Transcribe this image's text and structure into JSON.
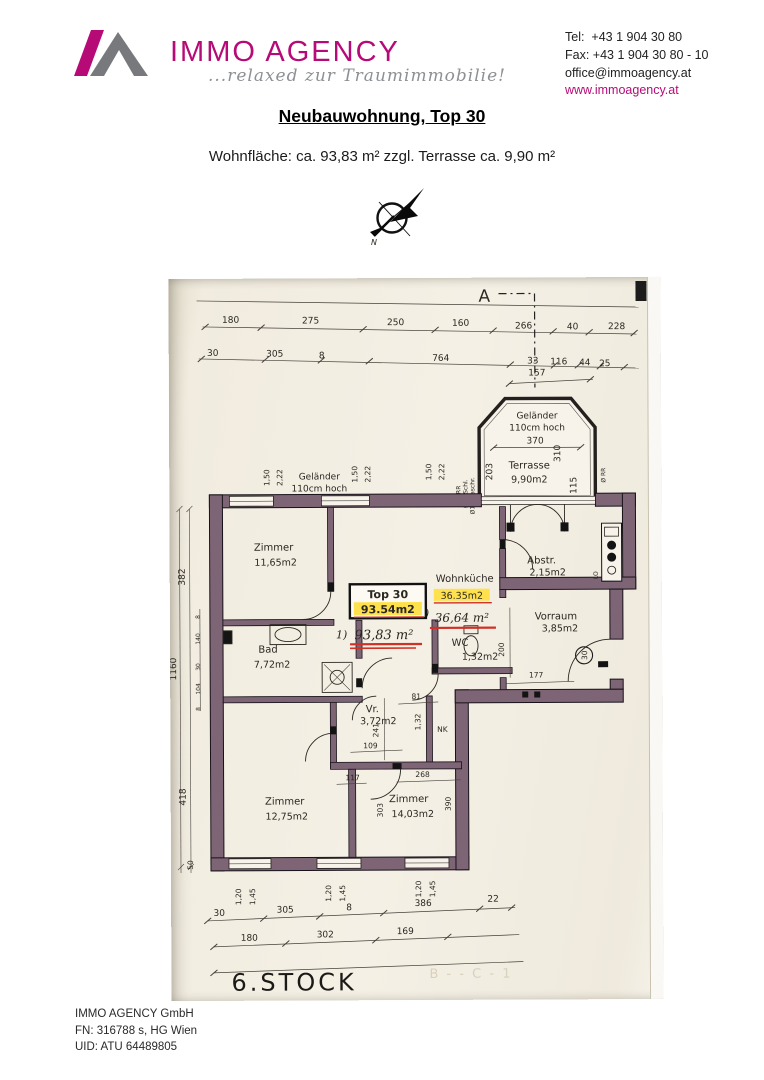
{
  "header": {
    "brand": "IMMO AGENCY",
    "tagline": "...relaxed zur Traumimmobilie!",
    "brand_color": "#b60b77",
    "contact": {
      "tel": "Tel:  +43 1 904 30 80",
      "fax": "Fax: +43 1 904 30 80 - 10",
      "email": "office@immoagency.at",
      "web": "www.immoagency.at"
    }
  },
  "document": {
    "title": "Neubauwohnung, Top 30",
    "subtitle": "Wohnfläche: ca. 93,83 m² zzgl. Terrasse ca. 9,90 m²"
  },
  "compass": {
    "north_label": "N"
  },
  "plan": {
    "section_marker": "A",
    "floor_label": "6.STOCK",
    "bleed_text": "B - - C - 1",
    "unit_label": {
      "box_line1": "Top 30",
      "box_line2": "93.54m2",
      "hand_prefix": "1)",
      "hand_area": "93,83 m²"
    },
    "rooms": {
      "zimmer1": {
        "name": "Zimmer",
        "area": "11,65m2"
      },
      "wohnkueche": {
        "name": "Wohnküche",
        "area_printed": "36.35m2",
        "hand_prefix": "1)",
        "area_hand": "36,64 m²"
      },
      "abstellraum": {
        "name": "Abstr.",
        "area": "2,15m2"
      },
      "terrasse": {
        "name": "Terrasse",
        "area": "9,90m2",
        "railing1": "Geländer",
        "railing2": "110cm hoch"
      },
      "vorraum": {
        "name": "Vorraum",
        "area": "3,85m2"
      },
      "bad": {
        "name": "Bad",
        "area": "7,72m2"
      },
      "wc": {
        "name": "WC",
        "area": "1,32m2"
      },
      "vr": {
        "name": "Vr.",
        "area": "3,72m2"
      },
      "zimmer2": {
        "name": "Zimmer",
        "area": "12,75m2"
      },
      "zimmer3": {
        "name": "Zimmer",
        "area": "14,03m2"
      }
    },
    "railing_left": {
      "line1": "Geländer",
      "line2": "110cm hoch"
    },
    "dims": {
      "top1": [
        "180",
        "275",
        "250",
        "160",
        "266",
        "40",
        "228"
      ],
      "top2": [
        "30",
        "305",
        "8",
        "764",
        "33",
        "116",
        "44",
        "25"
      ],
      "d157": "157",
      "terrace": {
        "w": "370",
        "left": "203",
        "right": "310",
        "lower": "115"
      },
      "left": {
        "total": "1160",
        "upper": "382",
        "lower": "418",
        "chain": [
          "8",
          "140",
          "30",
          "104",
          "8"
        ],
        "bottom": "50"
      },
      "win_top": [
        "1,50",
        "2,22"
      ],
      "win_bottom": [
        "1,20",
        "1,45"
      ],
      "inner": {
        "d200": "200",
        "d177": "177",
        "d241": "241",
        "d81": "81",
        "d109": "109",
        "d132": "1,32",
        "d117": "117",
        "d268": "268",
        "d303": "303",
        "d390": "390"
      },
      "bottom1": [
        "30",
        "305",
        "8",
        "386",
        "22"
      ],
      "bottom2": [
        "180",
        "302",
        "169"
      ]
    },
    "annotations": {
      "rr": "RR",
      "schl": "Ø10 Schl.",
      "maschr": "Ø10 Maschr.",
      "rr2": "Ø RR",
      "nk": "NK",
      "lo": "LO",
      "entry_door": "30"
    }
  },
  "footer": {
    "company": "IMMO AGENCY GmbH",
    "register": "FN: 316788 s, HG Wien",
    "uid": "UID: ATU 64489805"
  }
}
